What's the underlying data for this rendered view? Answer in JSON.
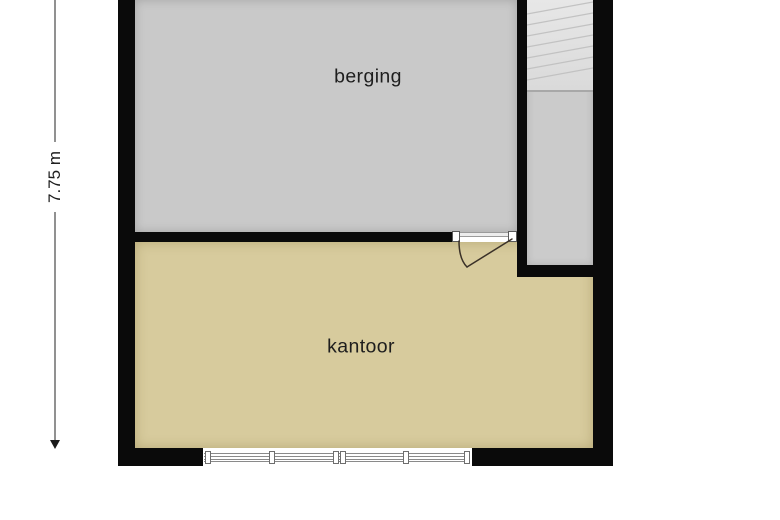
{
  "floorplan": {
    "rooms": [
      {
        "id": "berging",
        "label": "berging"
      },
      {
        "id": "kantoor",
        "label": "kantoor"
      }
    ],
    "dimensions": [
      {
        "label": "7.75 m",
        "orientation": "vertical",
        "side": "left"
      }
    ],
    "features": [
      {
        "name": "staircase",
        "location": "top-right"
      },
      {
        "name": "door-swing",
        "location": "between berging and kantoor"
      },
      {
        "name": "window-strip",
        "location": "bottom wall"
      }
    ]
  },
  "colors": {
    "wall": "#0a0a0a",
    "berging-fill": "#c9c9c9",
    "kantoor-fill": "#d7cb9d",
    "corridor-fill": "#cbcbcb",
    "stair-line": "#c2c2c2",
    "door-line": "#3a3128",
    "window-line": "#8a8a8a",
    "dim-line": "#919191",
    "text": "#1e1e1e"
  }
}
